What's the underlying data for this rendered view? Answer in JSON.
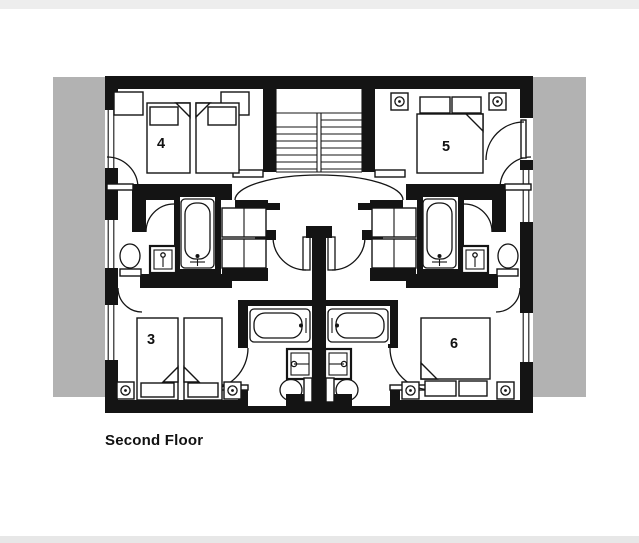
{
  "page": {
    "top_strip_color": "#ededed",
    "bottom_strip_color": "#e7e7e7",
    "background": "#ffffff"
  },
  "plan": {
    "title": "Second Floor",
    "colors": {
      "wall": "#141414",
      "band": "#b2b2b2",
      "line": "#141414",
      "door_leaf": "#8f8f8f",
      "interior": "#ffffff"
    },
    "rooms": [
      {
        "number": "4"
      },
      {
        "number": "5"
      },
      {
        "number": "3"
      },
      {
        "number": "6"
      }
    ],
    "fixtures": [
      "staircase",
      "bathtub",
      "toilet",
      "sink",
      "wardrobe",
      "single-bed",
      "double-bed",
      "ceiling-light",
      "bedside-table",
      "door",
      "window"
    ]
  }
}
